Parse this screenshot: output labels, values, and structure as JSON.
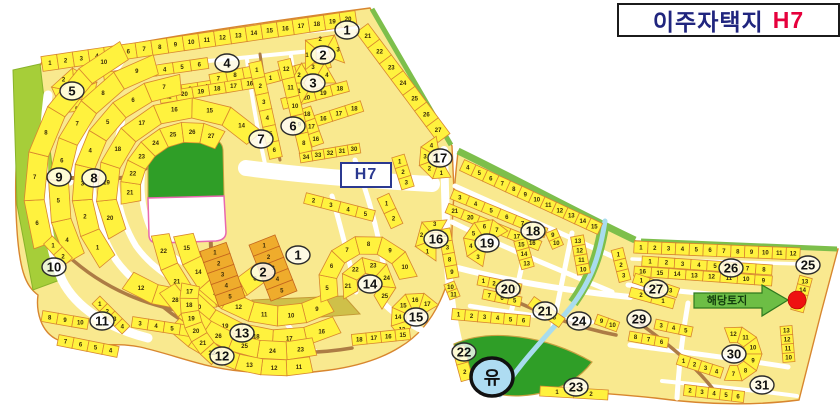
{
  "title": {
    "text": "이주자택지",
    "code": "H7"
  },
  "map_label": "H7",
  "callout": {
    "text": "해당토지"
  },
  "yu_label": "유",
  "colors": {
    "parcel_fill": "#FFF23E",
    "parcel_stroke": "#D8862F",
    "land_fill": "#F9E98F",
    "road": "#FFFFFF",
    "brown_road": "#AD7C45",
    "green_band": "#A6CE39",
    "green_strip": "#7DBF4B",
    "park": "#2F9E27",
    "stream": "#A8DCEE",
    "commercial": "#EFAC2C",
    "commercial_stroke": "#C4651E",
    "arrow_fill": "#6DBE45",
    "arrow_stroke": "#2F7A1F",
    "target_dot": "#EE1111",
    "title_navy": "#20257E",
    "title_red": "#E6003C",
    "h7_blue": "#2B3990"
  },
  "blocks": [
    {
      "n": "1",
      "x": 347,
      "y": 30
    },
    {
      "n": "2",
      "x": 323,
      "y": 55
    },
    {
      "n": "3",
      "x": 313,
      "y": 83
    },
    {
      "n": "4",
      "x": 227,
      "y": 63
    },
    {
      "n": "5",
      "x": 72,
      "y": 91
    },
    {
      "n": "6",
      "x": 293,
      "y": 126
    },
    {
      "n": "7",
      "x": 261,
      "y": 139
    },
    {
      "n": "8",
      "x": 94,
      "y": 178
    },
    {
      "n": "9",
      "x": 59,
      "y": 177
    },
    {
      "n": "10",
      "x": 54,
      "y": 267
    },
    {
      "n": "11",
      "x": 102,
      "y": 321
    },
    {
      "n": "12",
      "x": 222,
      "y": 356
    },
    {
      "n": "13",
      "x": 242,
      "y": 333
    },
    {
      "n": "14",
      "x": 370,
      "y": 284
    },
    {
      "n": "15",
      "x": 416,
      "y": 317
    },
    {
      "n": "16",
      "x": 436,
      "y": 239
    },
    {
      "n": "17",
      "x": 440,
      "y": 158
    },
    {
      "n": "18",
      "x": 533,
      "y": 231
    },
    {
      "n": "19",
      "x": 487,
      "y": 243
    },
    {
      "n": "20",
      "x": 508,
      "y": 289
    },
    {
      "n": "21",
      "x": 545,
      "y": 311
    },
    {
      "n": "22",
      "x": 464,
      "y": 352
    },
    {
      "n": "23",
      "x": 576,
      "y": 387
    },
    {
      "n": "24",
      "x": 579,
      "y": 321
    },
    {
      "n": "25",
      "x": 808,
      "y": 265
    },
    {
      "n": "26",
      "x": 731,
      "y": 268
    },
    {
      "n": "27",
      "x": 656,
      "y": 289
    },
    {
      "n": "29",
      "x": 639,
      "y": 319
    },
    {
      "n": "30",
      "x": 734,
      "y": 354
    },
    {
      "n": "31",
      "x": 762,
      "y": 385
    },
    {
      "n": "1",
      "x": 298,
      "y": 255
    },
    {
      "n": "2",
      "x": 263,
      "y": 272
    }
  ],
  "bands": [
    {
      "t": "l",
      "x1": 42,
      "y1": 64,
      "x2": 356,
      "y2": 18,
      "w": 15,
      "ns": [
        1,
        2,
        3,
        4,
        5,
        6,
        7,
        8,
        9,
        10,
        11,
        12,
        13,
        14,
        15,
        16,
        17,
        18,
        19,
        20
      ]
    },
    {
      "t": "l",
      "x1": 362,
      "y1": 28,
      "x2": 444,
      "y2": 138,
      "w": 15,
      "ns": [
        21,
        22,
        23,
        24,
        25,
        26,
        27
      ]
    },
    {
      "t": "l",
      "x1": 104,
      "y1": 78,
      "x2": 208,
      "y2": 63,
      "w": 11,
      "ns": [
        1,
        2,
        3,
        4,
        5,
        6
      ]
    },
    {
      "t": "l",
      "x1": 150,
      "y1": 95,
      "x2": 230,
      "y2": 83,
      "w": 11,
      "ns": [
        1,
        2,
        3,
        4,
        5
      ]
    },
    {
      "t": "l",
      "x1": 210,
      "y1": 80,
      "x2": 260,
      "y2": 70,
      "w": 11,
      "ns": [
        7,
        8,
        9
      ]
    },
    {
      "t": "a",
      "cx": 75,
      "cy": 92,
      "r1": 10,
      "r2": 24,
      "a1": 120,
      "a2": 480,
      "ns": [
        1,
        2,
        3,
        4,
        5
      ]
    },
    {
      "t": "l",
      "x1": 160,
      "y1": 98,
      "x2": 258,
      "y2": 82,
      "w": 11,
      "ns": [
        21,
        20,
        19,
        18,
        17,
        16
      ]
    },
    {
      "t": "l",
      "x1": 262,
      "y1": 80,
      "x2": 330,
      "y2": 62,
      "w": 11,
      "ns": [
        1,
        2,
        3,
        4
      ]
    },
    {
      "t": "l",
      "x1": 282,
      "y1": 104,
      "x2": 348,
      "y2": 86,
      "w": 11,
      "ns": [
        21,
        20,
        19,
        18
      ]
    },
    {
      "t": "l",
      "x1": 300,
      "y1": 126,
      "x2": 362,
      "y2": 106,
      "w": 11,
      "ns": [
        15,
        16,
        17,
        18
      ]
    },
    {
      "t": "l",
      "x1": 300,
      "y1": 158,
      "x2": 360,
      "y2": 148,
      "w": 10,
      "ns": [
        34,
        33,
        32,
        31,
        30
      ]
    },
    {
      "t": "a",
      "cx": 313,
      "cy": 83,
      "r1": 9,
      "r2": 23,
      "a1": 120,
      "a2": 360,
      "ns": [
        1,
        2,
        3,
        4
      ]
    },
    {
      "t": "a",
      "cx": 323,
      "cy": 55,
      "r1": 9,
      "r2": 23,
      "a1": 140,
      "a2": 380,
      "ns": [
        1,
        2,
        3
      ]
    },
    {
      "t": "l",
      "x1": 305,
      "y1": 108,
      "x2": 318,
      "y2": 145,
      "w": 12,
      "ns": [
        18,
        17,
        16
      ]
    },
    {
      "t": "a",
      "cx": 190,
      "cy": 192,
      "r1": 50,
      "r2": 70,
      "a1": 170,
      "a2": 300,
      "ns": [
        21,
        22,
        23,
        24,
        25,
        26,
        27
      ]
    },
    {
      "t": "a",
      "cx": 190,
      "cy": 192,
      "r1": 74,
      "r2": 94,
      "a1": 150,
      "a2": 320,
      "ns": [
        20,
        19,
        18,
        17,
        16,
        15,
        14
      ]
    },
    {
      "t": "a",
      "cx": 190,
      "cy": 192,
      "r1": 98,
      "r2": 118,
      "a1": 140,
      "a2": 265,
      "ns": [
        1,
        2,
        3,
        4,
        5,
        6,
        7
      ]
    },
    {
      "t": "a",
      "cx": 190,
      "cy": 192,
      "r1": 98,
      "r2": 118,
      "a1": 45,
      "a2": 125,
      "ns": [
        8,
        9,
        10,
        11,
        12
      ]
    },
    {
      "t": "a",
      "cx": 190,
      "cy": 192,
      "r1": 122,
      "r2": 142,
      "a1": 150,
      "a2": 255,
      "ns": [
        4,
        5,
        6,
        7,
        8,
        9
      ]
    },
    {
      "t": "a",
      "cx": 190,
      "cy": 192,
      "r1": 146,
      "r2": 166,
      "a1": 160,
      "a2": 245,
      "ns": [
        6,
        7,
        8,
        9,
        10
      ]
    },
    {
      "t": "a",
      "cx": 280,
      "cy": 218,
      "r1": 88,
      "r2": 108,
      "a1": 60,
      "a2": 170,
      "ns": [
        9,
        10,
        11,
        12,
        13,
        14,
        15
      ]
    },
    {
      "t": "a",
      "cx": 280,
      "cy": 218,
      "r1": 112,
      "r2": 130,
      "a1": 62,
      "a2": 172,
      "ns": [
        16,
        17,
        18,
        19,
        20,
        21,
        22
      ]
    },
    {
      "t": "a",
      "cx": 280,
      "cy": 218,
      "r1": 124,
      "r2": 142,
      "a1": 75,
      "a2": 148,
      "ns": [
        23,
        24,
        25,
        26,
        27,
        28
      ]
    },
    {
      "t": "a",
      "cx": 280,
      "cy": 218,
      "r1": 142,
      "r2": 158,
      "a1": 78,
      "a2": 135,
      "ns": [
        11,
        12,
        13,
        14,
        15,
        16
      ]
    },
    {
      "t": "l",
      "x1": 48,
      "y1": 240,
      "x2": 68,
      "y2": 262,
      "w": 12,
      "ns": [
        1,
        2
      ]
    },
    {
      "t": "l",
      "x1": 42,
      "y1": 316,
      "x2": 88,
      "y2": 324,
      "w": 11,
      "ns": [
        8,
        9,
        10
      ]
    },
    {
      "t": "l",
      "x1": 58,
      "y1": 340,
      "x2": 118,
      "y2": 352,
      "w": 11,
      "ns": [
        7,
        6,
        5,
        4
      ]
    },
    {
      "t": "l",
      "x1": 96,
      "y1": 300,
      "x2": 126,
      "y2": 330,
      "w": 11,
      "ns": [
        1,
        2,
        3,
        4
      ]
    },
    {
      "t": "l",
      "x1": 132,
      "y1": 322,
      "x2": 196,
      "y2": 332,
      "w": 11,
      "ns": [
        3,
        4,
        5,
        6
      ]
    },
    {
      "t": "a",
      "cx": 262,
      "cy": 300,
      "r1": 64,
      "r2": 82,
      "a1": 128,
      "a2": 192,
      "ns": [
        22,
        21,
        20,
        19,
        18,
        17
      ]
    },
    {
      "t": "l",
      "x1": 255,
      "y1": 62,
      "x2": 276,
      "y2": 158,
      "w": 13,
      "ns": [
        1,
        2,
        3,
        4,
        5,
        6
      ]
    },
    {
      "t": "l",
      "x1": 284,
      "y1": 60,
      "x2": 306,
      "y2": 152,
      "w": 13,
      "ns": [
        12,
        11,
        10,
        9,
        8
      ]
    },
    {
      "t": "l",
      "x1": 398,
      "y1": 156,
      "x2": 408,
      "y2": 188,
      "w": 13,
      "ns": [
        1,
        2,
        3
      ]
    },
    {
      "t": "l",
      "x1": 383,
      "y1": 196,
      "x2": 397,
      "y2": 226,
      "w": 13,
      "ns": [
        1,
        2
      ]
    },
    {
      "t": "l",
      "x1": 305,
      "y1": 198,
      "x2": 374,
      "y2": 216,
      "w": 11,
      "ns": [
        2,
        3,
        4,
        5
      ]
    },
    {
      "t": "a",
      "cx": 440,
      "cy": 158,
      "r1": 8,
      "r2": 22,
      "a1": 60,
      "a2": 260,
      "ns": [
        1,
        2,
        3,
        4
      ]
    },
    {
      "t": "a",
      "cx": 368,
      "cy": 285,
      "r1": 12,
      "r2": 28,
      "a1": 150,
      "a2": 420,
      "ns": [
        21,
        22,
        23,
        24,
        25
      ]
    },
    {
      "t": "a",
      "cx": 368,
      "cy": 285,
      "r1": 32,
      "r2": 50,
      "a1": 160,
      "a2": 350,
      "ns": [
        5,
        6,
        7,
        8,
        9,
        10
      ]
    },
    {
      "t": "a",
      "cx": 416,
      "cy": 318,
      "r1": 10,
      "r2": 26,
      "a1": 120,
      "a2": 330,
      "ns": [
        13,
        14,
        15,
        16,
        17
      ]
    },
    {
      "t": "l",
      "x1": 352,
      "y1": 340,
      "x2": 410,
      "y2": 334,
      "w": 11,
      "ns": [
        18,
        17,
        16,
        15
      ]
    },
    {
      "t": "a",
      "cx": 436,
      "cy": 239,
      "r1": 8,
      "r2": 22,
      "a1": 90,
      "a2": 300,
      "ns": [
        1,
        2,
        3
      ]
    },
    {
      "t": "l",
      "x1": 213,
      "y1": 247,
      "x2": 232,
      "y2": 302,
      "w": 28,
      "ns": [
        1,
        2,
        3,
        4,
        5
      ],
      "f": "#EFAC2C",
      "s": "#C4651E"
    },
    {
      "t": "l",
      "x1": 262,
      "y1": 240,
      "x2": 284,
      "y2": 296,
      "w": 28,
      "ns": [
        1,
        2,
        3,
        4,
        5
      ],
      "f": "#EFAC2C",
      "s": "#C4651E"
    },
    {
      "t": "l",
      "x1": 462,
      "y1": 165,
      "x2": 600,
      "y2": 229,
      "w": 12,
      "ns": [
        4,
        5,
        6,
        7,
        8,
        9,
        10,
        11,
        12,
        13,
        14,
        15
      ]
    },
    {
      "t": "l",
      "x1": 452,
      "y1": 194,
      "x2": 546,
      "y2": 233,
      "w": 10,
      "ns": [
        3,
        4,
        5,
        6,
        7,
        8
      ]
    },
    {
      "t": "l",
      "x1": 447,
      "y1": 208,
      "x2": 540,
      "y2": 246,
      "w": 10,
      "ns": [
        21,
        20,
        19,
        18,
        17,
        16
      ]
    },
    {
      "t": "l",
      "x1": 520,
      "y1": 240,
      "x2": 528,
      "y2": 268,
      "w": 13,
      "ns": [
        15,
        14,
        13
      ]
    },
    {
      "t": "l",
      "x1": 577,
      "y1": 236,
      "x2": 584,
      "y2": 274,
      "w": 13,
      "ns": [
        13,
        12,
        11,
        10
      ]
    },
    {
      "t": "l",
      "x1": 551,
      "y1": 231,
      "x2": 558,
      "y2": 247,
      "w": 12,
      "ns": [
        9,
        10
      ]
    },
    {
      "t": "a",
      "cx": 487,
      "cy": 243,
      "r1": 9,
      "r2": 24,
      "a1": 100,
      "a2": 330,
      "ns": [
        3,
        4,
        5,
        6,
        7
      ]
    },
    {
      "t": "l",
      "x1": 444,
      "y1": 229,
      "x2": 453,
      "y2": 278,
      "w": 12,
      "ns": [
        2,
        3,
        8,
        9
      ]
    },
    {
      "t": "l",
      "x1": 478,
      "y1": 280,
      "x2": 521,
      "y2": 289,
      "w": 10,
      "ns": [
        1,
        2,
        3,
        4
      ]
    },
    {
      "t": "l",
      "x1": 483,
      "y1": 294,
      "x2": 521,
      "y2": 302,
      "w": 10,
      "ns": [
        7,
        6,
        5
      ]
    },
    {
      "t": "l",
      "x1": 452,
      "y1": 314,
      "x2": 530,
      "y2": 321,
      "w": 11,
      "ns": [
        1,
        2,
        3,
        4,
        5,
        6
      ]
    },
    {
      "t": "l",
      "x1": 449,
      "y1": 283,
      "x2": 455,
      "y2": 298,
      "w": 11,
      "ns": [
        10,
        11
      ]
    },
    {
      "t": "l",
      "x1": 531,
      "y1": 301,
      "x2": 562,
      "y2": 323,
      "w": 11,
      "ns": [
        5,
        6
      ]
    },
    {
      "t": "l",
      "x1": 617,
      "y1": 249,
      "x2": 625,
      "y2": 281,
      "w": 12,
      "ns": [
        1,
        2,
        3
      ]
    },
    {
      "t": "l",
      "x1": 596,
      "y1": 319,
      "x2": 618,
      "y2": 327,
      "w": 10,
      "ns": [
        9,
        10
      ]
    },
    {
      "t": "l",
      "x1": 634,
      "y1": 247,
      "x2": 800,
      "y2": 254,
      "w": 12,
      "ns": [
        1,
        2,
        3,
        4,
        5,
        6,
        7,
        8,
        9,
        10,
        11,
        12
      ]
    },
    {
      "t": "l",
      "x1": 642,
      "y1": 261,
      "x2": 772,
      "y2": 270,
      "w": 10,
      "ns": [
        1,
        2,
        3,
        4,
        5,
        6,
        7,
        8
      ]
    },
    {
      "t": "l",
      "x1": 634,
      "y1": 271,
      "x2": 772,
      "y2": 281,
      "w": 10,
      "ns": [
        16,
        15,
        14,
        13,
        12,
        11,
        10,
        9
      ]
    },
    {
      "t": "l",
      "x1": 806,
      "y1": 277,
      "x2": 797,
      "y2": 311,
      "w": 13,
      "ns": [
        13,
        14,
        15,
        16
      ]
    },
    {
      "t": "l",
      "x1": 634,
      "y1": 278,
      "x2": 678,
      "y2": 293,
      "w": 10,
      "ns": [
        1,
        2,
        3
      ]
    },
    {
      "t": "l",
      "x1": 630,
      "y1": 292,
      "x2": 674,
      "y2": 304,
      "w": 10,
      "ns": [
        2,
        1
      ]
    },
    {
      "t": "l",
      "x1": 655,
      "y1": 324,
      "x2": 692,
      "y2": 332,
      "w": 10,
      "ns": [
        3,
        4,
        5
      ]
    },
    {
      "t": "l",
      "x1": 629,
      "y1": 336,
      "x2": 668,
      "y2": 343,
      "w": 10,
      "ns": [
        8,
        7,
        6
      ]
    },
    {
      "t": "a",
      "cx": 734,
      "cy": 354,
      "r1": 12,
      "r2": 28,
      "a1": 250,
      "a2": 470,
      "ns": [
        12,
        11,
        10,
        9,
        8,
        7
      ]
    },
    {
      "t": "l",
      "x1": 786,
      "y1": 326,
      "x2": 789,
      "y2": 362,
      "w": 12,
      "ns": [
        13,
        12,
        11,
        10
      ]
    },
    {
      "t": "l",
      "x1": 678,
      "y1": 359,
      "x2": 722,
      "y2": 373,
      "w": 11,
      "ns": [
        1,
        2,
        3,
        4
      ]
    },
    {
      "t": "l",
      "x1": 684,
      "y1": 390,
      "x2": 744,
      "y2": 397,
      "w": 11,
      "ns": [
        2,
        3,
        4,
        5,
        6
      ]
    },
    {
      "t": "l",
      "x1": 458,
      "y1": 347,
      "x2": 467,
      "y2": 380,
      "w": 12,
      "ns": [
        1,
        2
      ]
    },
    {
      "t": "l",
      "x1": 540,
      "y1": 391,
      "x2": 608,
      "y2": 395,
      "w": 10,
      "ns": [
        1,
        2
      ]
    }
  ]
}
